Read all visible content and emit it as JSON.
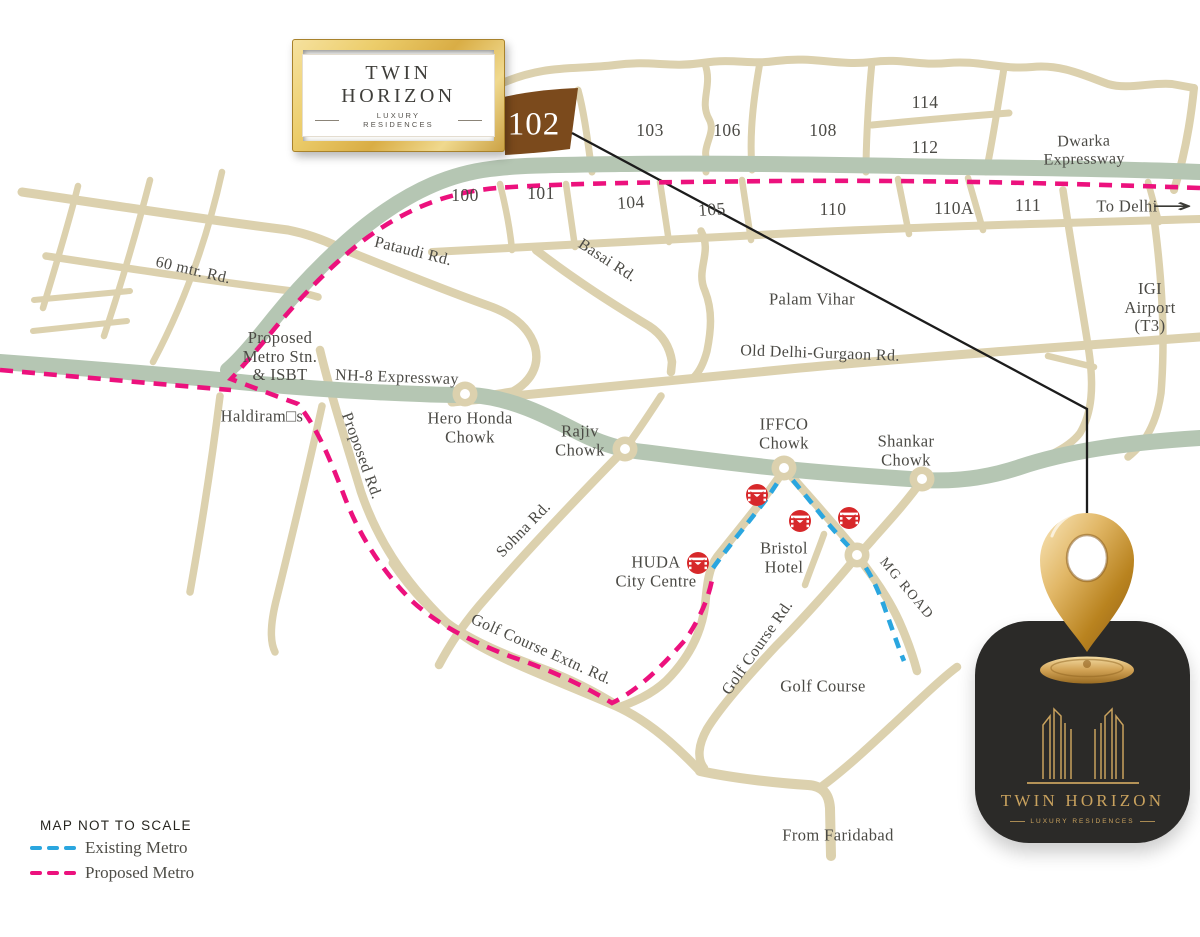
{
  "branding": {
    "frame_logo": {
      "title": "TWIN HORIZON",
      "subtitle": "LUXURY RESIDENCES"
    },
    "card_logo": {
      "title": "TWIN HORIZON",
      "subtitle": "LUXURY RESIDENCES"
    }
  },
  "legend": {
    "note": "MAP NOT TO SCALE",
    "items": [
      {
        "label": "Existing Metro",
        "color": "#2aa6df"
      },
      {
        "label": "Proposed Metro",
        "color": "#ec117d"
      }
    ]
  },
  "colors": {
    "road": "#dcd1ae",
    "expressway": "#b5c6b3",
    "highlight_sector": "#7b4a1c",
    "metro_red": "#d7282a",
    "label": "#4b4a45",
    "pointer": "#1c1c1c",
    "card": "#2b2a28",
    "gold": "#c9a25e"
  },
  "map": {
    "to_delhi_arrow": "→",
    "labels": [
      {
        "t": "Dwarka Expressway",
        "x": 1084,
        "y": 151,
        "r": -1,
        "c": "road"
      },
      {
        "t": "To Delhi",
        "x": 1127,
        "y": 207,
        "r": 0,
        "c": "place"
      },
      {
        "t": "102",
        "x": 534,
        "y": 125,
        "r": 0,
        "c": "sector-hl"
      },
      {
        "t": "103",
        "x": 650,
        "y": 131,
        "r": 0,
        "c": "sector"
      },
      {
        "t": "106",
        "x": 727,
        "y": 131,
        "r": 0,
        "c": "sector"
      },
      {
        "t": "108",
        "x": 823,
        "y": 131,
        "r": 0,
        "c": "sector"
      },
      {
        "t": "114",
        "x": 925,
        "y": 103,
        "r": 0,
        "c": "sector"
      },
      {
        "t": "112",
        "x": 925,
        "y": 148,
        "r": 0,
        "c": "sector"
      },
      {
        "t": "100",
        "x": 465,
        "y": 196,
        "r": 0,
        "c": "sector"
      },
      {
        "t": "101",
        "x": 541,
        "y": 194,
        "r": 0,
        "c": "sector"
      },
      {
        "t": "104",
        "x": 631,
        "y": 203,
        "r": -4,
        "c": "sector"
      },
      {
        "t": "105",
        "x": 712,
        "y": 210,
        "r": -4,
        "c": "sector"
      },
      {
        "t": "110",
        "x": 833,
        "y": 210,
        "r": 0,
        "c": "sector"
      },
      {
        "t": "110A",
        "x": 954,
        "y": 209,
        "r": 0,
        "c": "sector"
      },
      {
        "t": "111",
        "x": 1028,
        "y": 206,
        "r": 0,
        "c": "sector"
      },
      {
        "t": "IGI Airport\n(T3)",
        "x": 1150,
        "y": 308,
        "r": 0,
        "c": "place"
      },
      {
        "t": "Palam Vihar",
        "x": 812,
        "y": 300,
        "r": 0,
        "c": "place"
      },
      {
        "t": "Old Delhi-Gurgaon Rd.",
        "x": 820,
        "y": 354,
        "r": 2,
        "c": "road"
      },
      {
        "t": "Basai Rd.",
        "x": 607,
        "y": 261,
        "r": 33,
        "c": "road"
      },
      {
        "t": "Pataudi Rd.",
        "x": 413,
        "y": 252,
        "r": 14,
        "c": "road"
      },
      {
        "t": "60 mtr. Rd.",
        "x": 193,
        "y": 271,
        "r": 13,
        "c": "road"
      },
      {
        "t": "Proposed\nMetro Stn.\n& ISBT",
        "x": 280,
        "y": 357,
        "r": 0,
        "c": "place"
      },
      {
        "t": "NH-8 Expressway",
        "x": 397,
        "y": 378,
        "r": 2,
        "c": "road"
      },
      {
        "t": "Haldiram□s",
        "x": 262,
        "y": 417,
        "r": 0,
        "c": "place"
      },
      {
        "t": "Proposed Rd.",
        "x": 361,
        "y": 456,
        "r": 70,
        "c": "road"
      },
      {
        "t": "Hero Honda\nChowk",
        "x": 470,
        "y": 428,
        "r": 0,
        "c": "place"
      },
      {
        "t": "Rajiv\nChowk",
        "x": 580,
        "y": 441,
        "r": 0,
        "c": "place"
      },
      {
        "t": "Sohna Rd.",
        "x": 524,
        "y": 530,
        "r": -46,
        "c": "road"
      },
      {
        "t": "IFFCO\nChowk",
        "x": 784,
        "y": 434,
        "r": 0,
        "c": "place"
      },
      {
        "t": "Shankar\nChowk",
        "x": 906,
        "y": 451,
        "r": 0,
        "c": "place"
      },
      {
        "t": "HUDA\nCity Centre",
        "x": 656,
        "y": 572,
        "r": 0,
        "c": "place"
      },
      {
        "t": "Bristol\nHotel",
        "x": 784,
        "y": 558,
        "r": 0,
        "c": "place"
      },
      {
        "t": "MG ROAD",
        "x": 906,
        "y": 589,
        "r": 50,
        "c": "road-sm"
      },
      {
        "t": "Golf Course Extn. Rd.",
        "x": 541,
        "y": 650,
        "r": 24,
        "c": "road"
      },
      {
        "t": "Golf Course Rd.",
        "x": 758,
        "y": 648,
        "r": -55,
        "c": "road"
      },
      {
        "t": "Golf Course",
        "x": 823,
        "y": 687,
        "r": 0,
        "c": "place"
      },
      {
        "t": "From Faridabad",
        "x": 838,
        "y": 836,
        "r": 0,
        "c": "place"
      }
    ],
    "metro_stations": [
      {
        "x": 757,
        "y": 495
      },
      {
        "x": 800,
        "y": 521
      },
      {
        "x": 849,
        "y": 518
      },
      {
        "x": 698,
        "y": 563
      }
    ],
    "roundabouts": [
      {
        "x": 465,
        "y": 394
      },
      {
        "x": 625,
        "y": 449
      },
      {
        "x": 784,
        "y": 468
      },
      {
        "x": 922,
        "y": 479
      },
      {
        "x": 857,
        "y": 555
      }
    ]
  }
}
